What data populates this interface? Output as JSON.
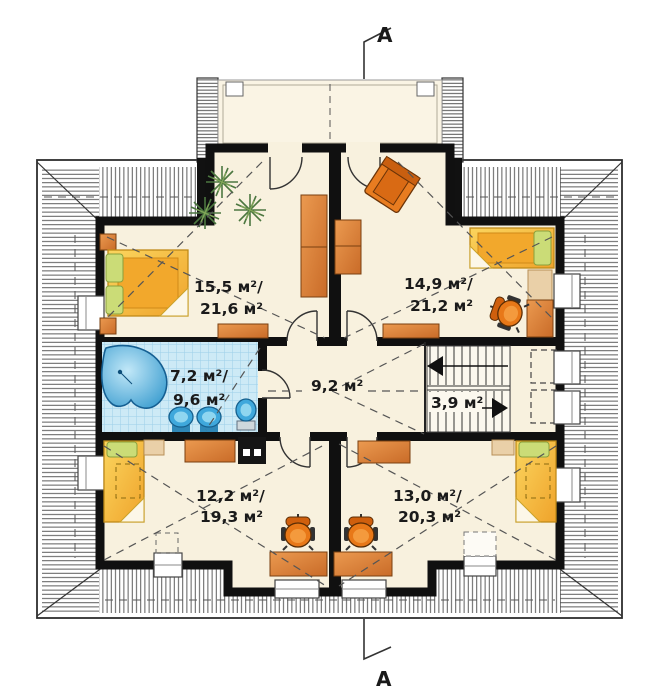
{
  "document": {
    "type": "attic floor plan",
    "section_label": "A"
  },
  "markers": {
    "top": "A",
    "bottom": "A"
  },
  "rooms": [
    {
      "name": "bedroom-top-left",
      "line1": "15,5 м²/",
      "line2": "21,6 м²"
    },
    {
      "name": "bedroom-top-right",
      "line1": "14,9 м²/",
      "line2": "21,2 м²"
    },
    {
      "name": "bathroom",
      "line1": "7,2 м²/",
      "line2": "9,6 м²"
    },
    {
      "name": "hall",
      "line1": "9,2 м²"
    },
    {
      "name": "staircase",
      "line1": "3,9 м²"
    },
    {
      "name": "bedroom-bottom-left",
      "line1": "12,2 м²/",
      "line2": "19,3 м²"
    },
    {
      "name": "bedroom-bottom-right",
      "line1": "13,0 м²/",
      "line2": "20,3 м²"
    }
  ],
  "colors": {
    "floor": "#f8f1de",
    "wall": "#111111",
    "roof_hatch": "#4a4a4a",
    "bath_tile": "#cdeaf6",
    "fixture_blue": "#3fa8dc",
    "furniture_wood": "#d9813c",
    "bed_yellow": "#f6bc3a",
    "pillow_green": "#cbdc77",
    "chair_orange": "#e87818",
    "plant_green": "#4c7740"
  }
}
